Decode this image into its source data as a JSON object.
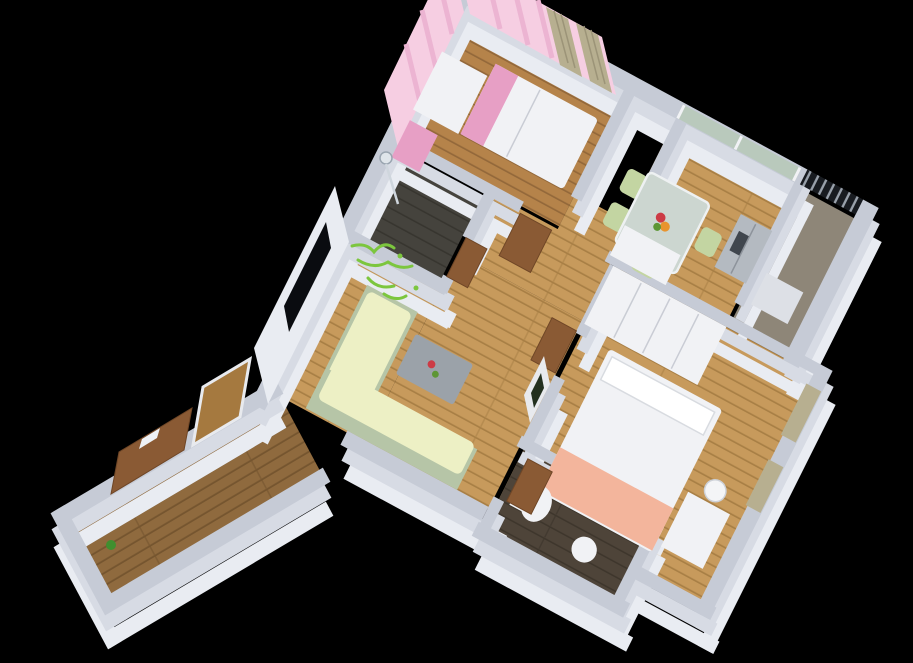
{
  "scene": {
    "title": "3D cutaway isometric floor plan render of a two-bedroom apartment on a black background",
    "style": "photoreal architectural dollhouse view, walls cut at waist height",
    "rooms": [
      {
        "id": "children-bedroom",
        "label": "Children's bedroom",
        "features": [
          "pink striped wallpaper",
          "single bed with white duvet",
          "pink head cushions",
          "white desk",
          "pink dresser",
          "tan curtains on window wall"
        ]
      },
      {
        "id": "dining-kitchen",
        "label": "Dining / kitchen",
        "features": [
          "glass dining table",
          "flower bouquet",
          "pale green chairs",
          "stainless refrigerator",
          "white counter",
          "full-width window"
        ]
      },
      {
        "id": "balcony",
        "label": "Balcony",
        "features": [
          "dark metal railing",
          "gray floor",
          "white unit"
        ]
      },
      {
        "id": "shower-bathroom",
        "label": "Shower bathroom",
        "features": [
          "dark tile floor",
          "chrome shower set",
          "green vine wall decal on outside wall"
        ]
      },
      {
        "id": "corridor",
        "label": "Corridor",
        "features": [
          "light oak plank floor",
          "wooden doors"
        ]
      },
      {
        "id": "living-room",
        "label": "Living room",
        "features": [
          "L-shaped pale green sofa",
          "gray coffee table with red flowers",
          "wall-mounted black TV",
          "white media niche"
        ]
      },
      {
        "id": "master-bedroom",
        "label": "Master bedroom",
        "features": [
          "large white wardrobe",
          "double bed with white duvet and salmon blanket",
          "tan curtains",
          "white desk and chair by window"
        ]
      },
      {
        "id": "second-bathroom",
        "label": "Second bathroom",
        "features": [
          "dark wood-tile floor",
          "white toilet",
          "white basin",
          "wooden door"
        ]
      },
      {
        "id": "entry-hall",
        "label": "Entry hall",
        "features": [
          "dark plank floor",
          "wooden entrance door with white slot",
          "wood-framed mirror",
          "small green plant"
        ]
      }
    ]
  },
  "palette": {
    "background": "#000000",
    "wallTop": "#c6cbd6",
    "wallMid": "#d7dbe4",
    "wallFace": "#e9ecf2",
    "woodLight": "#c79a5c",
    "woodLightLine": "#a87f45",
    "woodMid": "#b5834a",
    "woodMidLine": "#93683a",
    "woodDark": "#8f6a3e",
    "woodDarkLine": "#75552f",
    "tileShower": "#45433d",
    "tileShowerLine": "#37352f",
    "tileBath": "#4e4439",
    "tileBathLine": "#3e362c",
    "balconyFloor": "#8e8678",
    "railDark": "#181b20",
    "railLight": "#99a1ab",
    "pink": "#f6cee2",
    "pinkStripe": "#ecb4d2",
    "pinkDeep": "#e79fc5",
    "curtain": "#b7af90",
    "curtainDark": "#9c9478",
    "glassGreen": "#b7c9ba",
    "glassTable": "#ccd6d0",
    "sofaSage": "#b6c5a7",
    "sofaPale": "#edf0c5",
    "chairGreen": "#c3d5a2",
    "tableGray": "#9ba2a9",
    "steel": "#b4bac1",
    "steelDark": "#40464e",
    "furnWhite": "#f1f2f5",
    "doorBrown": "#8a5a34",
    "doorBrownDark": "#6f4626",
    "blanket": "#f3b59c",
    "tvBlack": "#0a0c10",
    "vine": "#7cc63e",
    "flowerRed": "#cc3b45",
    "flowerOrange": "#e8942e",
    "flowerGreen": "#5d9634"
  }
}
